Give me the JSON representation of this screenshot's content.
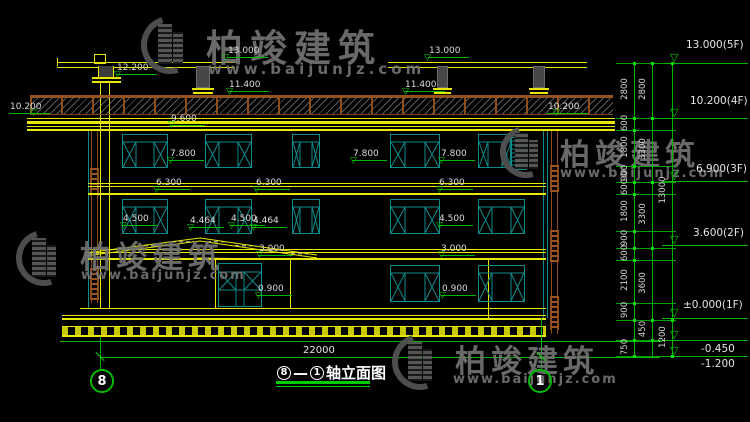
{
  "title": {
    "axis_start": "8",
    "separator": "—",
    "axis_end": "1",
    "label": "轴立面图"
  },
  "axes": {
    "left_bubble": "8",
    "right_bubble": "1"
  },
  "bottom_dimension": "22000",
  "watermark": {
    "brand": "柏竣建筑",
    "url": "www.baijunjz.com"
  },
  "colors": {
    "line_yellow": "#e8e800",
    "line_green": "#00b400",
    "window_teal": "#0e8c8c",
    "rail_brown": "#8a4a1a",
    "text_white": "#dcdcdc",
    "watermark_gray": "#747474"
  },
  "level_markers": [
    {
      "v": "13.000",
      "tx": 227,
      "ty": 46,
      "lx": 222,
      "ly": 63
    },
    {
      "v": "13.000",
      "tx": 428,
      "ty": 46,
      "lx": 424,
      "ly": 63
    },
    {
      "v": "12.200",
      "tx": 116,
      "ty": 63,
      "lx": 114,
      "ly": 80
    },
    {
      "v": "11.400",
      "tx": 228,
      "ty": 80,
      "lx": 226,
      "ly": 97
    },
    {
      "v": "11.400",
      "tx": 404,
      "ty": 80,
      "lx": 402,
      "ly": 97
    },
    {
      "v": "10.200",
      "tx": 9,
      "ty": 102,
      "lx": 30,
      "ly": 118
    },
    {
      "v": "10.200",
      "tx": 547,
      "ty": 102,
      "lx": 553,
      "ly": 118
    },
    {
      "v": "9.600",
      "tx": 170,
      "ty": 114,
      "lx": 168,
      "ly": 130
    },
    {
      "v": "7.800",
      "tx": 169,
      "ty": 149,
      "lx": 167,
      "ly": 166
    },
    {
      "v": "7.800",
      "tx": 352,
      "ty": 149,
      "lx": 350,
      "ly": 166
    },
    {
      "v": "7.800",
      "tx": 440,
      "ty": 149,
      "lx": 438,
      "ly": 166
    },
    {
      "v": "6.300",
      "tx": 155,
      "ty": 178,
      "lx": 153,
      "ly": 195
    },
    {
      "v": "6.300",
      "tx": 255,
      "ty": 178,
      "lx": 253,
      "ly": 195
    },
    {
      "v": "6.300",
      "tx": 438,
      "ty": 178,
      "lx": 436,
      "ly": 195
    },
    {
      "v": "4.500",
      "tx": 122,
      "ty": 214,
      "lx": 120,
      "ly": 231
    },
    {
      "v": "4.464",
      "tx": 189,
      "ty": 216,
      "lx": 187,
      "ly": 233
    },
    {
      "v": "4.500",
      "tx": 230,
      "ty": 214,
      "lx": 228,
      "ly": 231
    },
    {
      "v": "4.464",
      "tx": 252,
      "ty": 216,
      "lx": 250,
      "ly": 233
    },
    {
      "v": "4.500",
      "tx": 438,
      "ty": 214,
      "lx": 436,
      "ly": 231
    },
    {
      "v": "3.000",
      "tx": 258,
      "ty": 244,
      "lx": 256,
      "ly": 260
    },
    {
      "v": "3.000",
      "tx": 440,
      "ty": 244,
      "lx": 438,
      "ly": 260
    },
    {
      "v": "0.900",
      "tx": 257,
      "ty": 284,
      "lx": 255,
      "ly": 301
    },
    {
      "v": "0.900",
      "tx": 441,
      "ty": 284,
      "lx": 439,
      "ly": 301
    }
  ],
  "right_flags": [
    {
      "label": "13.000(5F)",
      "tx": 686,
      "ty": 39,
      "ly": 63,
      "below": false
    },
    {
      "label": "10.200(4F)",
      "tx": 690,
      "ty": 95,
      "ly": 118,
      "below": false
    },
    {
      "label": "6.900(3F)",
      "tx": 696,
      "ty": 163,
      "ly": 181,
      "below": false
    },
    {
      "label": "3.600(2F)",
      "tx": 693,
      "ty": 227,
      "ly": 245,
      "below": false
    },
    {
      "label": "±0.000(1F)",
      "tx": 683,
      "ty": 299,
      "ly": 318,
      "below": false
    },
    {
      "label": "-0.450",
      "tx": 701,
      "ty": 343,
      "ly": 340,
      "below": true
    },
    {
      "label": "-1.200",
      "tx": 701,
      "ty": 358,
      "ly": 356,
      "below": true
    }
  ],
  "dim_chains": [
    {
      "x": 634,
      "y1": 63,
      "y2": 356,
      "labels": [
        [
          "2800",
          90
        ],
        [
          "600",
          124
        ],
        [
          "1800",
          148
        ],
        [
          "900",
          174
        ],
        [
          "600",
          188
        ],
        [
          "1800",
          212
        ],
        [
          "900",
          239
        ],
        [
          "600",
          254
        ],
        [
          "2100",
          281
        ],
        [
          "900",
          311
        ],
        [
          "750",
          348
        ]
      ],
      "ticks": [
        63,
        118,
        130,
        166,
        182,
        194,
        231,
        248,
        260,
        303,
        320,
        340,
        356
      ]
    },
    {
      "x": 652,
      "y1": 63,
      "y2": 356,
      "labels": [
        [
          "2800",
          90
        ],
        [
          "3300",
          150
        ],
        [
          "3300",
          215
        ],
        [
          "3600",
          284
        ],
        [
          "450",
          330
        ]
      ],
      "ticks": [
        63,
        118,
        182,
        248,
        320,
        340
      ]
    },
    {
      "x": 672,
      "y1": 63,
      "y2": 356,
      "labels": [
        [
          "13000",
          191
        ],
        [
          "1200",
          338
        ]
      ],
      "ticks": [
        63,
        320,
        356
      ]
    }
  ],
  "connector_ys": [
    63,
    118,
    130,
    166,
    182,
    194,
    231,
    248,
    260,
    303,
    320,
    340,
    356
  ],
  "windows": {
    "rows": [
      {
        "y": 134,
        "h": 34,
        "kind": "std",
        "items": [
          [
            122,
            46
          ],
          [
            205,
            47
          ],
          [
            292,
            28
          ],
          [
            390,
            50
          ],
          [
            478,
            34
          ]
        ]
      },
      {
        "y": 199,
        "h": 35,
        "kind": "std",
        "items": [
          [
            122,
            46
          ],
          [
            205,
            47
          ],
          [
            292,
            28
          ],
          [
            390,
            50
          ],
          [
            478,
            47
          ]
        ]
      },
      {
        "y": 265,
        "h": 37,
        "kind": "std",
        "items": [
          [
            390,
            50
          ],
          [
            478,
            47
          ]
        ]
      }
    ],
    "entrance": {
      "x": 218,
      "y": 263,
      "w": 44,
      "h": 44
    },
    "grille": {
      "x": 510,
      "y": 137,
      "w": 17,
      "h": 33
    }
  }
}
